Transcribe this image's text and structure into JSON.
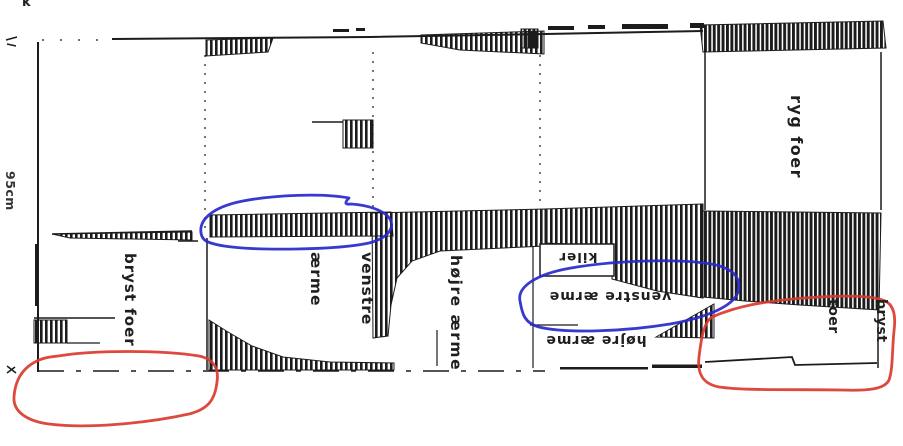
{
  "colors": {
    "ink": "#1c1c1c",
    "paper": "#ffffff",
    "red": "#da3a2c",
    "blue": "#2828cc",
    "text": "#1f1f1f"
  },
  "dimensions": {
    "top_width": "250 cm",
    "left_height": "95cm"
  },
  "marks": {
    "top_left": "k"
  },
  "pieces": {
    "bryst_foer_left": {
      "label": "bryst foer"
    },
    "venstre_aerme": {
      "line1": "venstre",
      "line2": "ærme"
    },
    "hoejre_aerme": {
      "label": "højre ærme"
    },
    "kiler": {
      "label": "kiler"
    },
    "venstre_aerme_flipped": {
      "label": "venstre ærme"
    },
    "hoejre_aerme_flipped": {
      "label": "højre ærme"
    },
    "ryg_foer": {
      "label": "ryg foer"
    },
    "bryst_toer": {
      "line1": "bryst",
      "line2": "toer"
    }
  }
}
